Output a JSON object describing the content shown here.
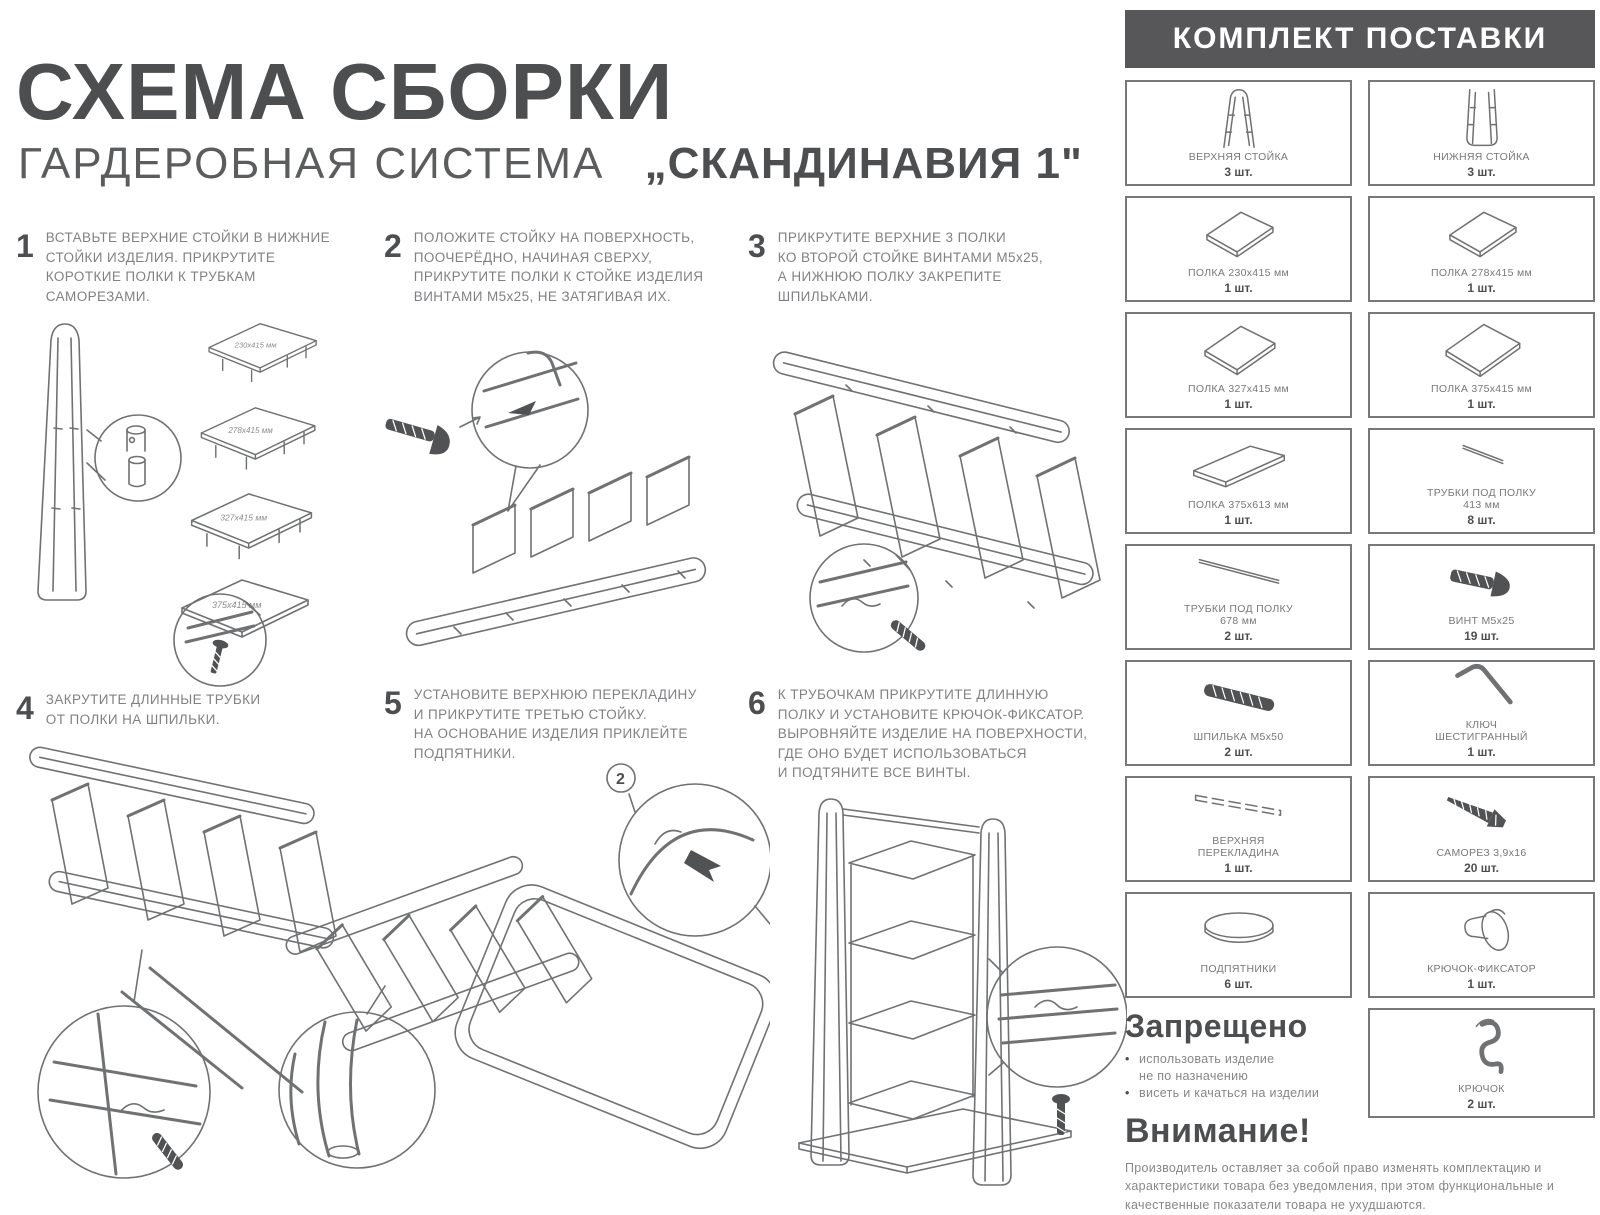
{
  "title": "СХЕМА СБОРКИ",
  "subtitle": "ГАРДЕРОБНАЯ СИСТЕМА",
  "product_name": "„СКАНДИНАВИЯ 1\"",
  "steps": [
    {
      "num": "1",
      "text": "ВСТАВЬТЕ ВЕРХНИЕ СТОЙКИ В НИЖНИЕ\nСТОЙКИ ИЗДЕЛИЯ. ПРИКРУТИТЕ\nКОРОТКИЕ ПОЛКИ К ТРУБКАМ\nСАМОРЕЗАМИ."
    },
    {
      "num": "2",
      "text": "ПОЛОЖИТЕ СТОЙКУ НА ПОВЕРХНОСТЬ,\nПООЧЕРЁДНО, НАЧИНАЯ СВЕРХУ,\nПРИКРУТИТЕ ПОЛКИ К СТОЙКЕ ИЗДЕЛИЯ\nВИНТАМИ М5х25, НЕ ЗАТЯГИВАЯ ИХ."
    },
    {
      "num": "3",
      "text": "ПРИКРУТИТЕ ВЕРХНИЕ 3 ПОЛКИ\nКО ВТОРОЙ СТОЙКЕ ВИНТАМИ М5х25,\nА НИЖНЮЮ ПОЛКУ ЗАКРЕПИТЕ\nШПИЛЬКАМИ."
    },
    {
      "num": "4",
      "text": "ЗАКРУТИТЕ ДЛИННЫЕ ТРУБКИ\nОТ ПОЛКИ НА ШПИЛЬКИ."
    },
    {
      "num": "5",
      "text": "УСТАНОВИТЕ ВЕРХНЮЮ ПЕРЕКЛАДИНУ\nИ ПРИКРУТИТЕ ТРЕТЬЮ СТОЙКУ.\nНА ОСНОВАНИЕ ИЗДЕЛИЯ ПРИКЛЕЙТЕ\nПОДПЯТНИКИ."
    },
    {
      "num": "6",
      "text": "К ТРУБОЧКАМ ПРИКРУТИТЕ ДЛИННУЮ\nПОЛКУ И УСТАНОВИТЕ КРЮЧОК-ФИКСАТОР.\nВЫРОВНЯЙТЕ ИЗДЕЛИЕ НА ПОВЕРХНОСТИ,\nГДЕ ОНО БУДЕТ ИСПОЛЬЗОВАТЬСЯ\nИ ПОДТЯНИТЕ ВСЕ ВИНТЫ."
    }
  ],
  "step1_labels": [
    "230х415 мм",
    "278х415 мм",
    "327х415 мм",
    "375х415 мм"
  ],
  "step5_callout": "2",
  "kit": {
    "header": "КОМПЛЕКТ ПОСТАВКИ",
    "items": [
      {
        "name": "ВЕРХНЯЯ СТОЙКА",
        "qty": "3 шт.",
        "icon": "upper-stand-icon"
      },
      {
        "name": "НИЖНЯЯ СТОЙКА",
        "qty": "3 шт.",
        "icon": "lower-stand-icon"
      },
      {
        "name": "ПОЛКА 230х415 мм",
        "qty": "1 шт.",
        "icon": "shelf-icon"
      },
      {
        "name": "ПОЛКА 278х415 мм",
        "qty": "1 шт.",
        "icon": "shelf-icon"
      },
      {
        "name": "ПОЛКА 327х415 мм",
        "qty": "1 шт.",
        "icon": "shelf-icon"
      },
      {
        "name": "ПОЛКА 375х415 мм",
        "qty": "1 шт.",
        "icon": "shelf-icon"
      },
      {
        "name": "ПОЛКА 375х613 мм",
        "qty": "1 шт.",
        "icon": "long-shelf-icon"
      },
      {
        "name": "ТРУБКИ ПОД ПОЛКУ\n413 мм",
        "qty": "8 шт.",
        "icon": "tube-short-icon"
      },
      {
        "name": "ТРУБКИ ПОД ПОЛКУ\n678 мм",
        "qty": "2 шт.",
        "icon": "tube-long-icon"
      },
      {
        "name": "ВИНТ М5х25",
        "qty": "19 шт.",
        "icon": "bolt-icon"
      },
      {
        "name": "ШПИЛЬКА М5х50",
        "qty": "2 шт.",
        "icon": "stud-icon"
      },
      {
        "name": "КЛЮЧ\nШЕСТИГРАННЫЙ",
        "qty": "1 шт.",
        "icon": "hex-key-icon"
      },
      {
        "name": "ВЕРХНЯЯ\nПЕРЕКЛАДИНА",
        "qty": "1 шт.",
        "icon": "crossbar-icon"
      },
      {
        "name": "САМОРЕЗ 3,9х16",
        "qty": "20 шт.",
        "icon": "screw-icon"
      },
      {
        "name": "ПОДПЯТНИКИ",
        "qty": "6 шт.",
        "icon": "foot-pad-icon"
      },
      {
        "name": "КРЮЧОК-ФИКСАТОР",
        "qty": "1 шт.",
        "icon": "hook-lock-icon"
      },
      {
        "name": "КРЮЧОК",
        "qty": "2 шт.",
        "icon": "hook-icon"
      }
    ]
  },
  "forbidden": {
    "title": "Запрещено",
    "bullets": [
      "использовать изделие\nне по назначению",
      "висеть и качаться на изделии"
    ]
  },
  "attention": {
    "title": "Внимание!",
    "text": "Производитель оставляет за собой право изменять комплектацию и характеристики товара без уведомления, при этом функциональные и качественные показатели товара не ухудшаются."
  },
  "colors": {
    "ink": "#58595b",
    "line": "#6f7173",
    "header_bg": "#57575a",
    "header_text": "#ffffff"
  }
}
